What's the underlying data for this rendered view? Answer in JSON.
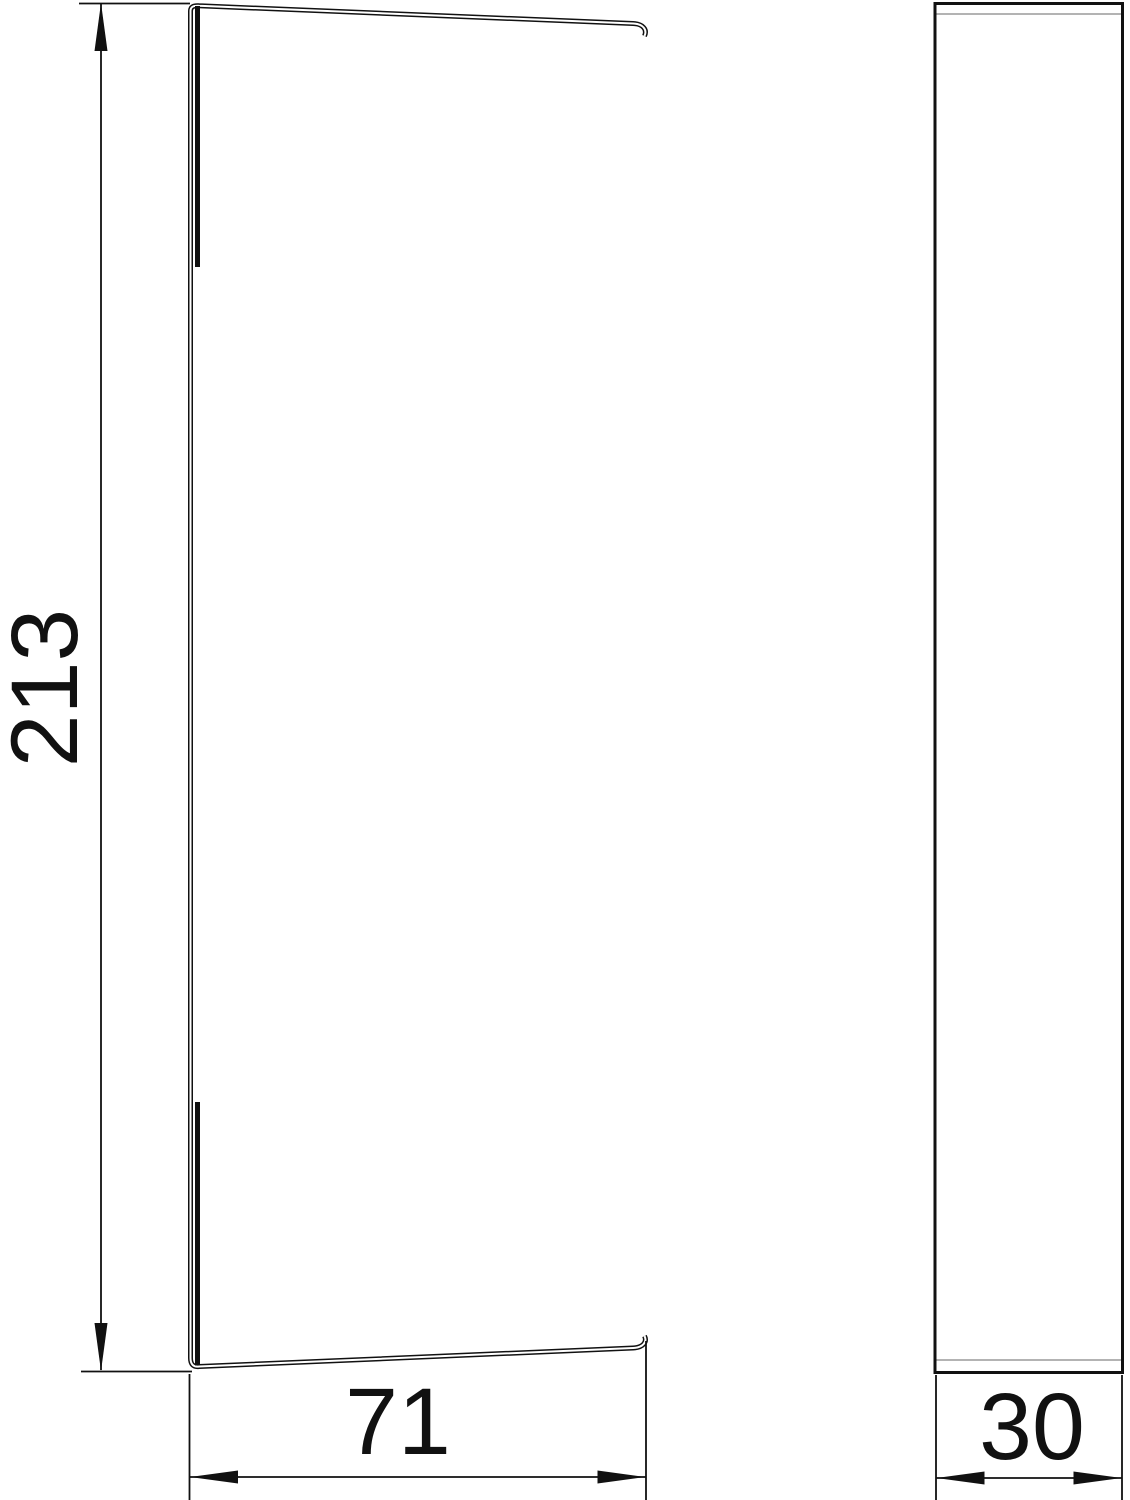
{
  "drawing": {
    "type": "technical-dimension-drawing",
    "dimensions": {
      "height": {
        "value": "213"
      },
      "width": {
        "value": "71"
      },
      "depth": {
        "value": "30"
      }
    }
  },
  "colors": {
    "line": "#111111",
    "secondary_line": "#9a9a9a",
    "background": "#ffffff"
  }
}
